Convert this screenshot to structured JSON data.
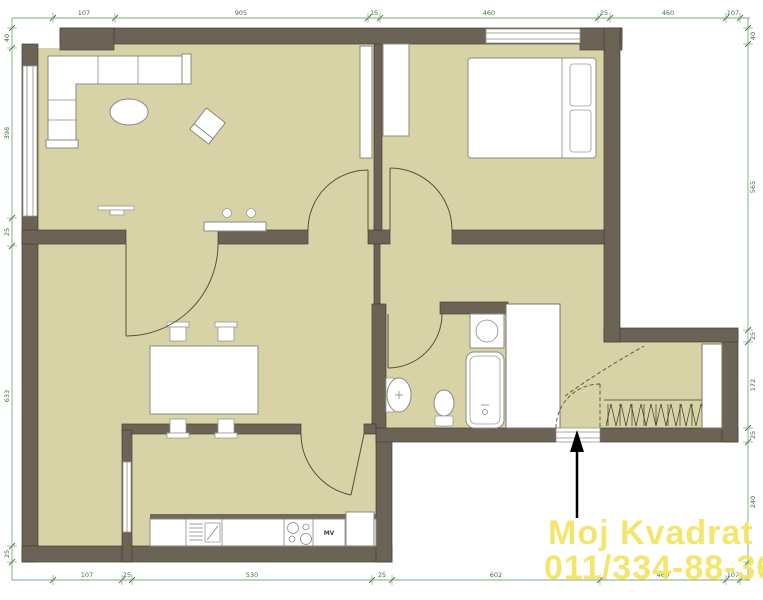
{
  "watermark": {
    "line1": "Moj Kvadrat",
    "line2": "011/334-88-36",
    "color": "#f3e462"
  },
  "appliance_label": "MV",
  "colors": {
    "floor": "#d7d3a6",
    "wall": "#6b6355",
    "dimension_line": "#7da87d",
    "dimension_text": "#3f6e3f",
    "watermark": "#f3e462",
    "arrow": "#000000"
  },
  "icons": [
    "corner-sofa-icon",
    "coffee-table-icon",
    "armchair-icon",
    "tv-icon",
    "sideboard-icon",
    "double-bed-icon",
    "pillow-icon",
    "wardrobe-icon",
    "dining-table-icon",
    "stool-icon",
    "kitchen-counter-icon",
    "sink-drainer-icon",
    "stove-icon",
    "fridge-icon",
    "washing-machine-icon",
    "bathtub-icon",
    "toilet-icon",
    "washbasin-icon",
    "hanger-closet-icon",
    "door-swing-icon",
    "window-icon",
    "entrance-arrow-icon"
  ],
  "dimensions": {
    "top": {
      "ticks": [
        53,
        115,
        368,
        380,
        598,
        610,
        726,
        740
      ],
      "labels": [
        {
          "t": "107",
          "p": 84
        },
        {
          "t": "905",
          "p": 241
        },
        {
          "t": "25",
          "p": 374
        },
        {
          "t": "460",
          "p": 489
        },
        {
          "t": "25",
          "p": 604
        },
        {
          "t": "460",
          "p": 668
        },
        {
          "t": "107",
          "p": 733
        }
      ]
    },
    "bottom": {
      "ticks": [
        53,
        122,
        132,
        372,
        392,
        600,
        726,
        740
      ],
      "labels": [
        {
          "t": "107",
          "p": 87
        },
        {
          "t": "25",
          "p": 127
        },
        {
          "t": "530",
          "p": 252
        },
        {
          "t": "25",
          "p": 382
        },
        {
          "t": "602",
          "p": 496
        },
        {
          "t": "460",
          "p": 663
        },
        {
          "t": "107",
          "p": 733
        }
      ]
    },
    "left": {
      "ticks": [
        28,
        48,
        218,
        246,
        546,
        562
      ],
      "labels": [
        {
          "t": "40",
          "p": 38
        },
        {
          "t": "398",
          "p": 133
        },
        {
          "t": "25",
          "p": 232
        },
        {
          "t": "633",
          "p": 396
        },
        {
          "t": "25",
          "p": 554
        }
      ]
    },
    "right": {
      "ticks": [
        28,
        44,
        330,
        342,
        428,
        442,
        562
      ],
      "labels": [
        {
          "t": "40",
          "p": 36
        },
        {
          "t": "565",
          "p": 187
        },
        {
          "t": "25",
          "p": 336
        },
        {
          "t": "172",
          "p": 385
        },
        {
          "t": "25",
          "p": 435
        },
        {
          "t": "240",
          "p": 502
        }
      ]
    }
  }
}
